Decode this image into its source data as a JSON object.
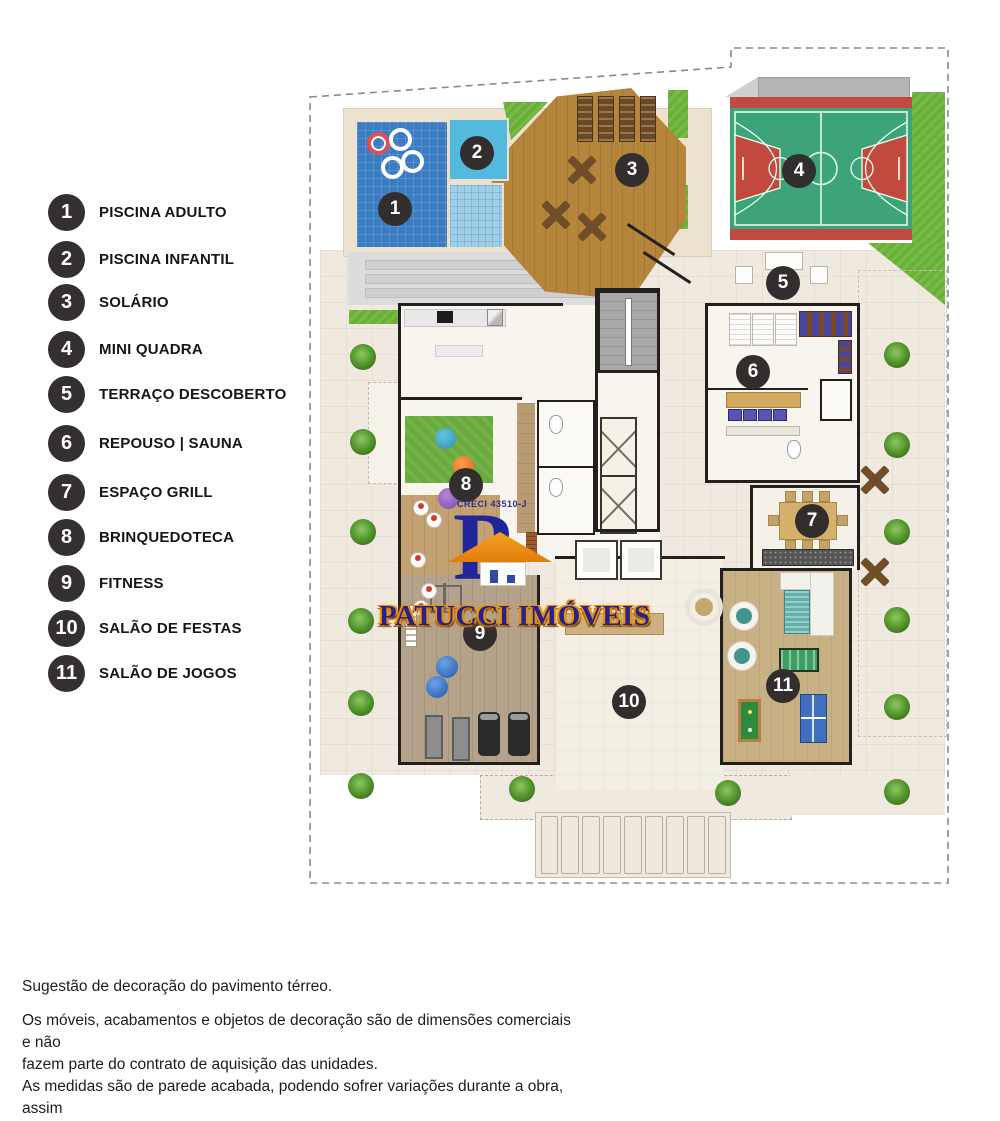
{
  "legend": {
    "items": [
      {
        "num": "1",
        "label": "PISCINA ADULTO"
      },
      {
        "num": "2",
        "label": "PISCINA INFANTIL"
      },
      {
        "num": "3",
        "label": "SOLÁRIO"
      },
      {
        "num": "4",
        "label": "MINI QUADRA"
      },
      {
        "num": "5",
        "label": "TERRAÇO DESCOBERTO"
      },
      {
        "num": "6",
        "label": "REPOUSO | SAUNA"
      },
      {
        "num": "7",
        "label": "ESPAÇO GRILL"
      },
      {
        "num": "8",
        "label": "BRINQUEDOTECA"
      },
      {
        "num": "9",
        "label": "FITNESS"
      },
      {
        "num": "10",
        "label": "SALÃO DE FESTAS"
      },
      {
        "num": "11",
        "label": "SALÃO DE JOGOS"
      }
    ]
  },
  "plan": {
    "markers": [
      {
        "num": "1",
        "x": 90,
        "y": 169
      },
      {
        "num": "2",
        "x": 172,
        "y": 113
      },
      {
        "num": "3",
        "x": 327,
        "y": 130
      },
      {
        "num": "4",
        "x": 494,
        "y": 131
      },
      {
        "num": "5",
        "x": 478,
        "y": 243
      },
      {
        "num": "6",
        "x": 448,
        "y": 332
      },
      {
        "num": "7",
        "x": 507,
        "y": 481
      },
      {
        "num": "8",
        "x": 161,
        "y": 445
      },
      {
        "num": "9",
        "x": 175,
        "y": 594
      },
      {
        "num": "10",
        "x": 324,
        "y": 662
      },
      {
        "num": "11",
        "x": 478,
        "y": 646
      }
    ],
    "logo": {
      "creci": "CRECI 43510-J",
      "monogram": "P",
      "wordmark": "PATUCCI IMÓVEIS"
    },
    "colors": {
      "pool_blue": "#3a7cc2",
      "kids_pool_blue": "#54b9de",
      "deck_wood": "#b5853c",
      "court_green": "#3da47a",
      "court_red": "#c2493e",
      "grass_green": "#68b136",
      "pavement_beige": "#efe9df",
      "logo_navy": "#252192",
      "logo_orange": "#f0941a"
    }
  },
  "footer": {
    "title": "Sugestão de decoração do pavimento térreo.",
    "lines": [
      "Os móveis, acabamentos e objetos de decoração são de dimensões comerciais e não",
      "fazem parte do contrato de aquisição das unidades.",
      "As medidas são de parede acabada, podendo sofrer variações durante a obra, assim",
      "como os pontos elétricos e hidráulicos.",
      "As unidades serão entregues conforme memorial descritivo."
    ]
  }
}
